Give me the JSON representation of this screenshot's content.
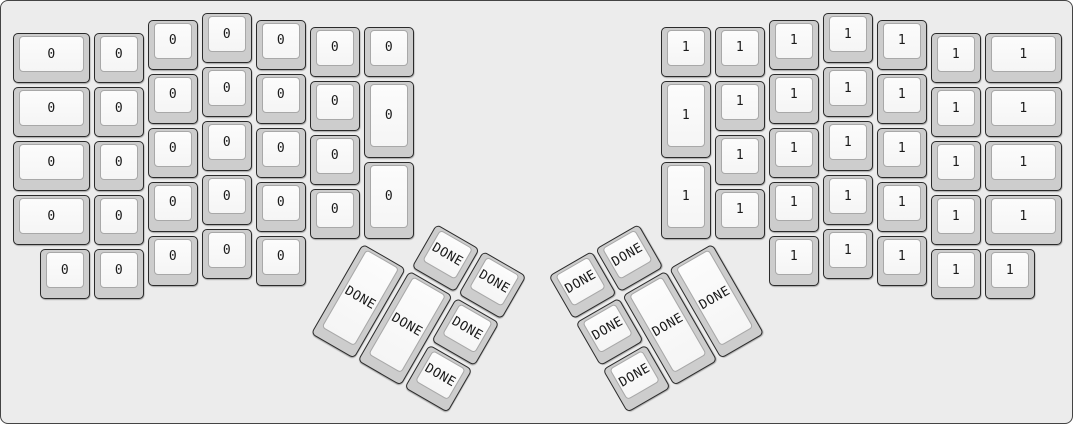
{
  "app": {
    "description": "keyboard-layout-editor render of an ErgoDox keyboard",
    "left_half_label": "0",
    "right_half_label": "1",
    "thumb_label": "DONE"
  },
  "canvas": {
    "width_px": 1073,
    "height_px": 424,
    "background": "#ececec",
    "border_color": "#444444"
  },
  "key_style": {
    "cap_color": "#cdcdcd",
    "cap_border_color": "#2b2b2b",
    "top_color": "#f9f9f9",
    "top_border_color": "#a8a8a8",
    "label_color": "#1a1a1a"
  },
  "layout": {
    "unit_px": 54,
    "origin_px": [
      10,
      10
    ],
    "groups": [
      {
        "name": "left-main",
        "rotation_deg": 0,
        "rx": 0,
        "ry": 0,
        "keys": [
          {
            "x": 0,
            "y": 0.375,
            "w": 1.5,
            "label": "0"
          },
          {
            "x": 1.5,
            "y": 0.375,
            "label": "0"
          },
          {
            "x": 2.5,
            "y": 0.125,
            "label": "0"
          },
          {
            "x": 3.5,
            "y": 0,
            "label": "0"
          },
          {
            "x": 4.5,
            "y": 0.125,
            "label": "0"
          },
          {
            "x": 5.5,
            "y": 0.25,
            "label": "0"
          },
          {
            "x": 6.5,
            "y": 0.25,
            "label": "0"
          },
          {
            "x": 0,
            "y": 1.375,
            "w": 1.5,
            "label": "0"
          },
          {
            "x": 1.5,
            "y": 1.375,
            "label": "0"
          },
          {
            "x": 2.5,
            "y": 1.125,
            "label": "0"
          },
          {
            "x": 3.5,
            "y": 1,
            "label": "0"
          },
          {
            "x": 4.5,
            "y": 1.125,
            "label": "0"
          },
          {
            "x": 5.5,
            "y": 1.25,
            "label": "0"
          },
          {
            "x": 6.5,
            "y": 1.25,
            "h": 1.5,
            "label": "0"
          },
          {
            "x": 0,
            "y": 2.375,
            "w": 1.5,
            "label": "0"
          },
          {
            "x": 1.5,
            "y": 2.375,
            "label": "0"
          },
          {
            "x": 2.5,
            "y": 2.125,
            "label": "0"
          },
          {
            "x": 3.5,
            "y": 2,
            "label": "0"
          },
          {
            "x": 4.5,
            "y": 2.125,
            "label": "0"
          },
          {
            "x": 5.5,
            "y": 2.25,
            "label": "0"
          },
          {
            "x": 6.5,
            "y": 2.75,
            "h": 1.5,
            "label": "0"
          },
          {
            "x": 0,
            "y": 3.375,
            "w": 1.5,
            "label": "0"
          },
          {
            "x": 1.5,
            "y": 3.375,
            "label": "0"
          },
          {
            "x": 2.5,
            "y": 3.125,
            "label": "0"
          },
          {
            "x": 3.5,
            "y": 3,
            "label": "0"
          },
          {
            "x": 4.5,
            "y": 3.125,
            "label": "0"
          },
          {
            "x": 5.5,
            "y": 3.25,
            "label": "0"
          },
          {
            "x": 0.5,
            "y": 4.375,
            "label": "0"
          },
          {
            "x": 1.5,
            "y": 4.375,
            "label": "0"
          },
          {
            "x": 2.5,
            "y": 4.125,
            "label": "0"
          },
          {
            "x": 3.5,
            "y": 4,
            "label": "0"
          },
          {
            "x": 4.5,
            "y": 4.125,
            "label": "0"
          }
        ]
      },
      {
        "name": "right-main",
        "rotation_deg": 0,
        "rx": 0,
        "ry": 0,
        "keys": [
          {
            "x": 12,
            "y": 0.25,
            "label": "1"
          },
          {
            "x": 13,
            "y": 0.25,
            "label": "1"
          },
          {
            "x": 14,
            "y": 0.125,
            "label": "1"
          },
          {
            "x": 15,
            "y": 0,
            "label": "1"
          },
          {
            "x": 16,
            "y": 0.125,
            "label": "1"
          },
          {
            "x": 17,
            "y": 0.375,
            "label": "1"
          },
          {
            "x": 18,
            "y": 0.375,
            "w": 1.5,
            "label": "1"
          },
          {
            "x": 12,
            "y": 1.25,
            "h": 1.5,
            "label": "1"
          },
          {
            "x": 13,
            "y": 1.25,
            "label": "1"
          },
          {
            "x": 14,
            "y": 1.125,
            "label": "1"
          },
          {
            "x": 15,
            "y": 1,
            "label": "1"
          },
          {
            "x": 16,
            "y": 1.125,
            "label": "1"
          },
          {
            "x": 17,
            "y": 1.375,
            "label": "1"
          },
          {
            "x": 18,
            "y": 1.375,
            "w": 1.5,
            "label": "1"
          },
          {
            "x": 13,
            "y": 2.25,
            "label": "1"
          },
          {
            "x": 14,
            "y": 2.125,
            "label": "1"
          },
          {
            "x": 15,
            "y": 2,
            "label": "1"
          },
          {
            "x": 16,
            "y": 2.125,
            "label": "1"
          },
          {
            "x": 17,
            "y": 2.375,
            "label": "1"
          },
          {
            "x": 18,
            "y": 2.375,
            "w": 1.5,
            "label": "1"
          },
          {
            "x": 12,
            "y": 2.75,
            "h": 1.5,
            "label": "1"
          },
          {
            "x": 13,
            "y": 3.25,
            "label": "1"
          },
          {
            "x": 14,
            "y": 3.125,
            "label": "1"
          },
          {
            "x": 15,
            "y": 3,
            "label": "1"
          },
          {
            "x": 16,
            "y": 3.125,
            "label": "1"
          },
          {
            "x": 17,
            "y": 3.375,
            "label": "1"
          },
          {
            "x": 18,
            "y": 3.375,
            "w": 1.5,
            "label": "1"
          },
          {
            "x": 14,
            "y": 4.125,
            "label": "1"
          },
          {
            "x": 15,
            "y": 4,
            "label": "1"
          },
          {
            "x": 16,
            "y": 4.125,
            "label": "1"
          },
          {
            "x": 17,
            "y": 4.375,
            "label": "1"
          },
          {
            "x": 18,
            "y": 4.375,
            "label": "1"
          }
        ]
      },
      {
        "name": "left-thumb-cluster",
        "rotation_deg": 30,
        "rx": 6.5,
        "ry": 4.25,
        "keys": [
          {
            "x": 1,
            "y": -1,
            "label": "DONE"
          },
          {
            "x": 2,
            "y": -1,
            "label": "DONE"
          },
          {
            "x": 0,
            "y": 0,
            "h": 2,
            "label": "DONE"
          },
          {
            "x": 1,
            "y": 0,
            "h": 2,
            "label": "DONE"
          },
          {
            "x": 2,
            "y": 0,
            "label": "DONE"
          },
          {
            "x": 2,
            "y": 1,
            "label": "DONE"
          }
        ]
      },
      {
        "name": "right-thumb-cluster",
        "rotation_deg": -30,
        "rx": 13,
        "ry": 4.25,
        "keys": [
          {
            "x": -3,
            "y": -1,
            "label": "DONE"
          },
          {
            "x": -2,
            "y": -1,
            "label": "DONE"
          },
          {
            "x": -3,
            "y": 0,
            "label": "DONE"
          },
          {
            "x": -2,
            "y": 0,
            "h": 2,
            "label": "DONE"
          },
          {
            "x": -1,
            "y": 0,
            "h": 2,
            "label": "DONE"
          },
          {
            "x": -3,
            "y": 1,
            "label": "DONE"
          }
        ]
      }
    ]
  }
}
